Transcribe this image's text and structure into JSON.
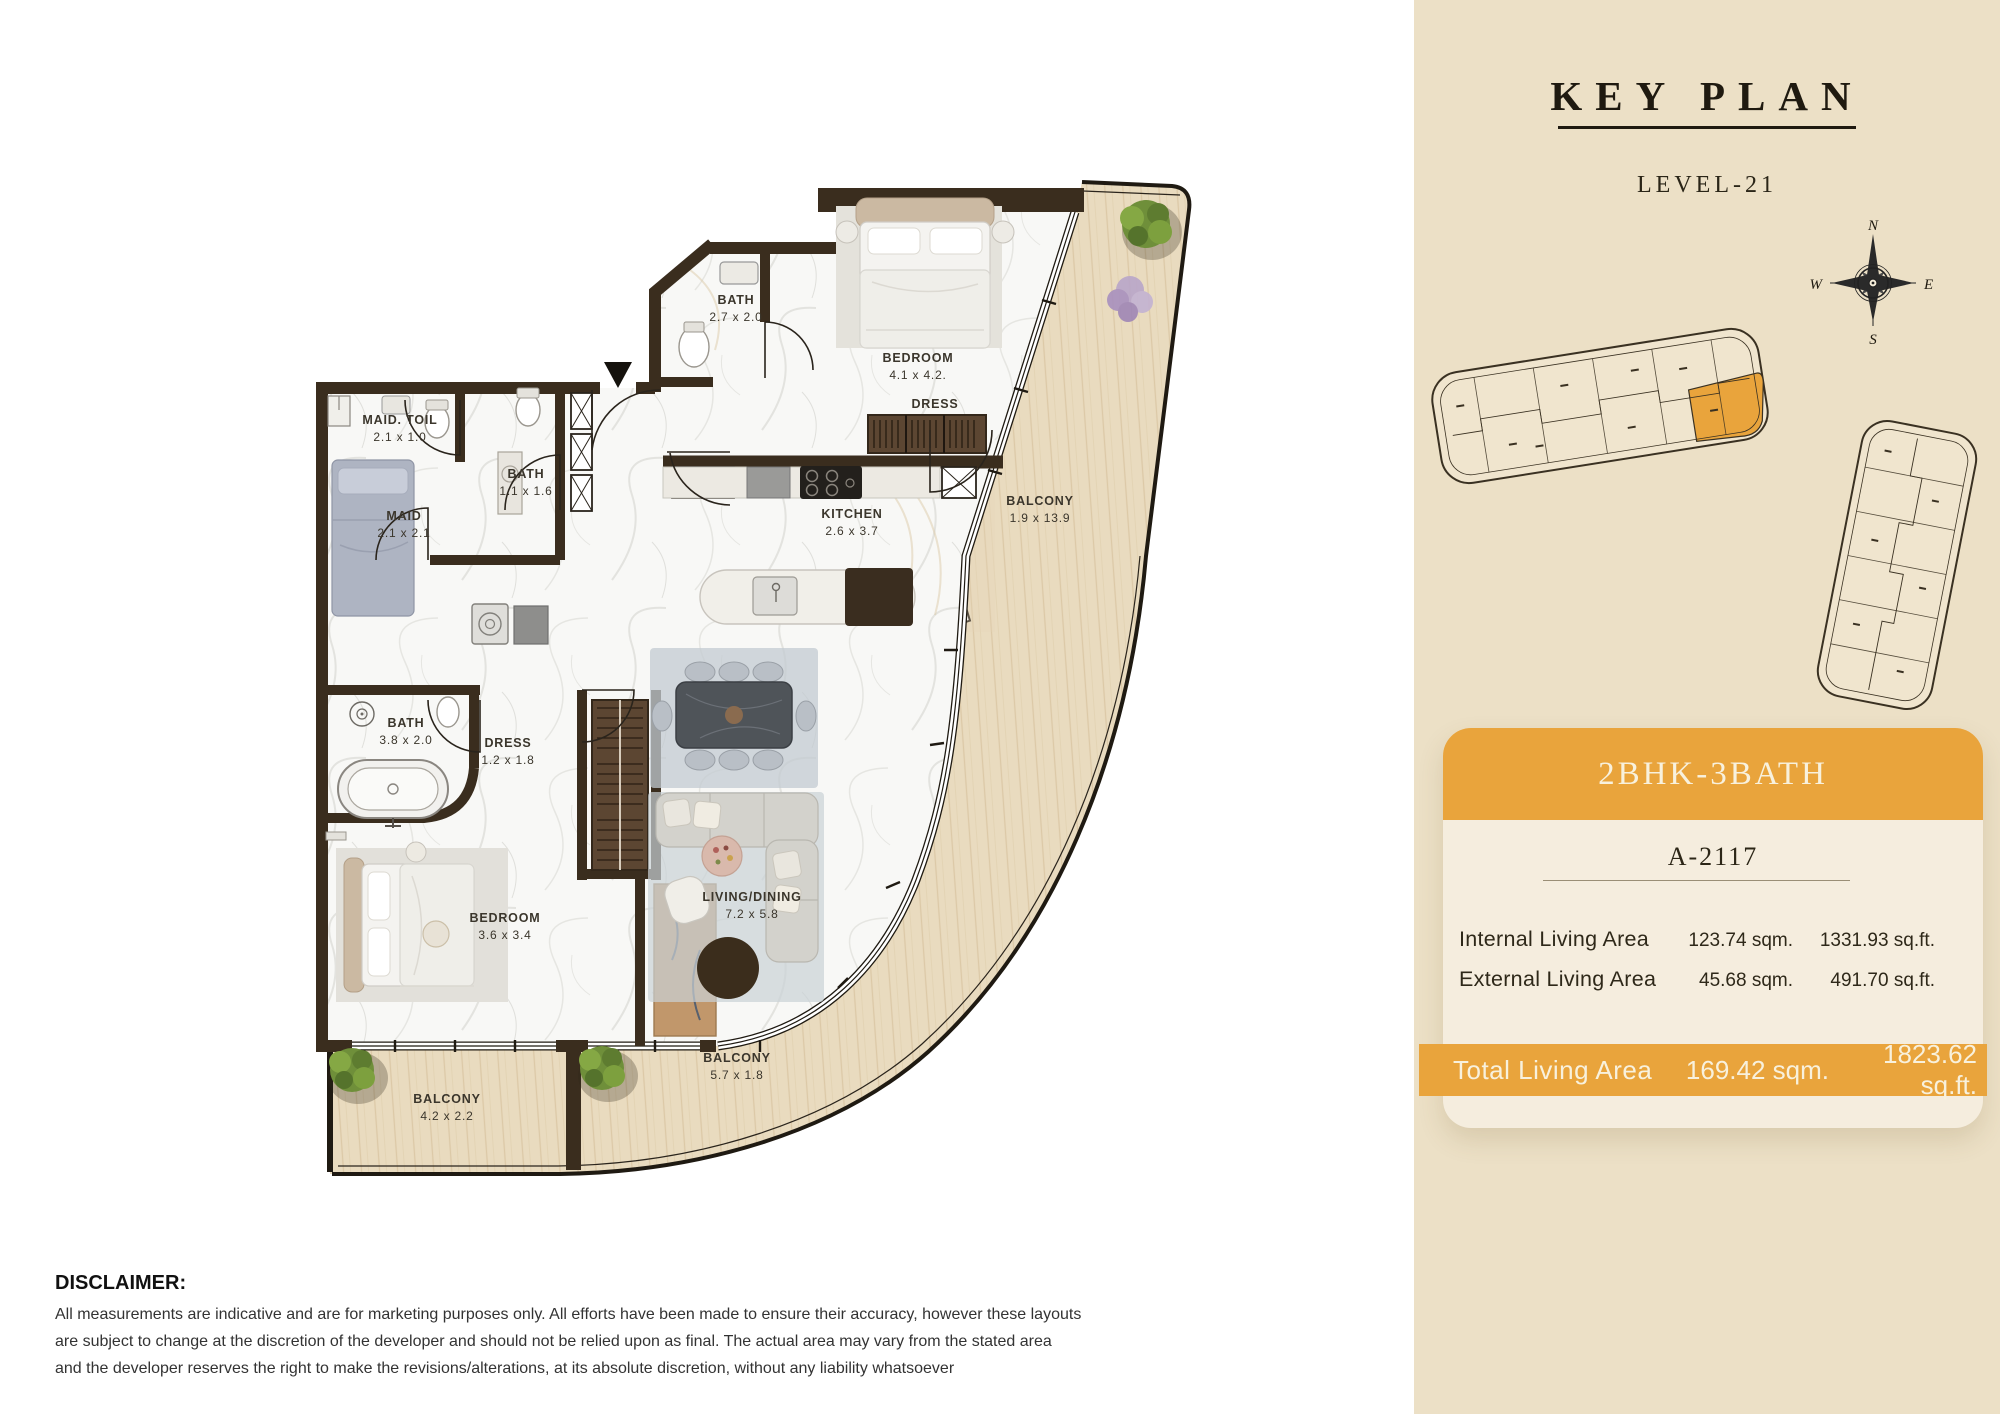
{
  "floor_plan": {
    "entrance_marker": "▼",
    "rooms": [
      {
        "name": "BATH",
        "dims": "2.7 x 2.0",
        "x": 736,
        "y": 304
      },
      {
        "name": "BEDROOM",
        "dims": "4.1 x 4.2.",
        "x": 918,
        "y": 362
      },
      {
        "name": "DRESS",
        "dims": "",
        "x": 935,
        "y": 406
      },
      {
        "name": "MAID. TOIL",
        "dims": "2.1 x 1.0",
        "x": 400,
        "y": 424
      },
      {
        "name": "BATH",
        "dims": "1.1 x 1.6",
        "x": 526,
        "y": 478
      },
      {
        "name": "MAID",
        "dims": "2.1 x 2.1",
        "x": 404,
        "y": 520
      },
      {
        "name": "KITCHEN",
        "dims": "2.6 x 3.7",
        "x": 852,
        "y": 518
      },
      {
        "name": "BALCONY",
        "dims": "1.9 x 13.9",
        "x": 1040,
        "y": 505
      },
      {
        "name": "BATH",
        "dims": "3.8 x 2.0",
        "x": 406,
        "y": 727
      },
      {
        "name": "DRESS",
        "dims": "1.2 x 1.8",
        "x": 508,
        "y": 747
      },
      {
        "name": "BEDROOM",
        "dims": "3.6 x 3.4",
        "x": 505,
        "y": 922
      },
      {
        "name": "LIVING/DINING",
        "dims": "7.2 x 5.8",
        "x": 752,
        "y": 901
      },
      {
        "name": "BALCONY",
        "dims": "5.7 x 1.8",
        "x": 737,
        "y": 1062
      },
      {
        "name": "BALCONY",
        "dims": "4.2 x 2.2",
        "x": 447,
        "y": 1103
      }
    ]
  },
  "key_plan": {
    "title": "KEY PLAN",
    "level": "LEVEL-21",
    "compass": {
      "n": "N",
      "e": "E",
      "s": "S",
      "w": "W"
    },
    "colors": {
      "panel": "#ECE0C6",
      "highlight": "#E9A43C",
      "outline": "#3A3122"
    }
  },
  "unit_card": {
    "type": "2BHK-3BATH",
    "unit": "A-2117",
    "rows": [
      {
        "label": "Internal Living Area",
        "sqm": "123.74 sqm.",
        "sqft": "1331.93 sq.ft."
      },
      {
        "label": "External Living Area",
        "sqm": "45.68 sqm.",
        "sqft": "491.70 sq.ft."
      }
    ],
    "total": {
      "label": "Total Living Area",
      "sqm": "169.42 sqm.",
      "sqft": "1823.62 sq.ft."
    }
  },
  "disclaimer": {
    "heading": "DISCLAIMER:",
    "lines": [
      "All measurements are indicative and are for marketing purposes only. All efforts have been made to ensure their accuracy, however these layouts",
      "are subject to change at the discretion of the developer and should not be relied upon as final. The actual area may vary from the stated area",
      "and the developer reserves the right to make the revisions/alterations, at its absolute discretion, without any liability whatsoever"
    ]
  }
}
